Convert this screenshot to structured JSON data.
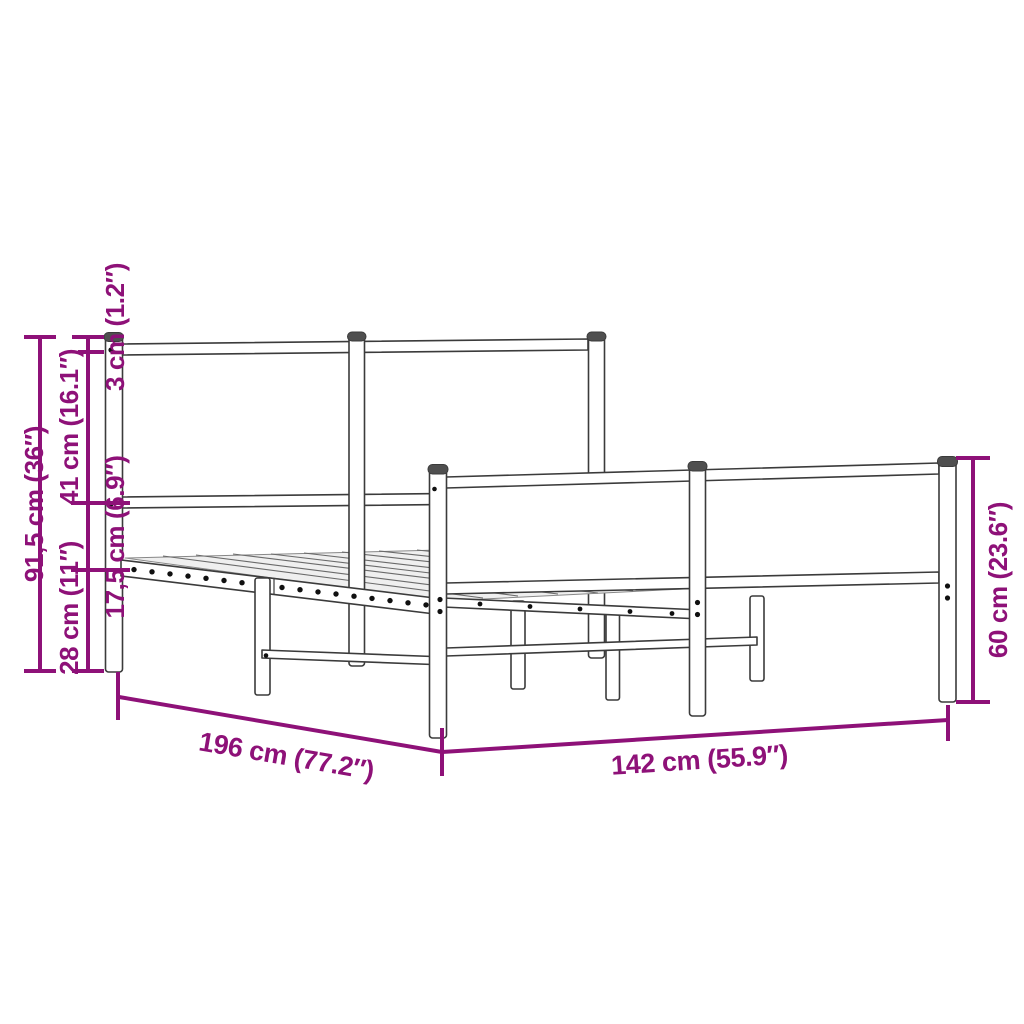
{
  "diagram": {
    "type": "product-dimension-diagram",
    "subject": "metal bed frame with headboard and footboard",
    "colors": {
      "dimension": "#8E1178",
      "outline": "#3B3B3B",
      "thin_line": "#6A6A6A",
      "cap_fill": "#4F4F4F",
      "hole_fill": "#101010",
      "background": "#FFFFFF"
    },
    "labels": {
      "total_height": "91,5 cm (36″)",
      "headboard_section": "41 cm (16.1″)",
      "clearance": "28 cm (11″)",
      "top_rail": "3 cm (1.2″)",
      "side_rail": "17,5 cm (6.9″)",
      "footboard_height": "60 cm (23.6″)",
      "length": "196 cm (77.2″)",
      "width": "142 cm (55.9″)"
    }
  }
}
